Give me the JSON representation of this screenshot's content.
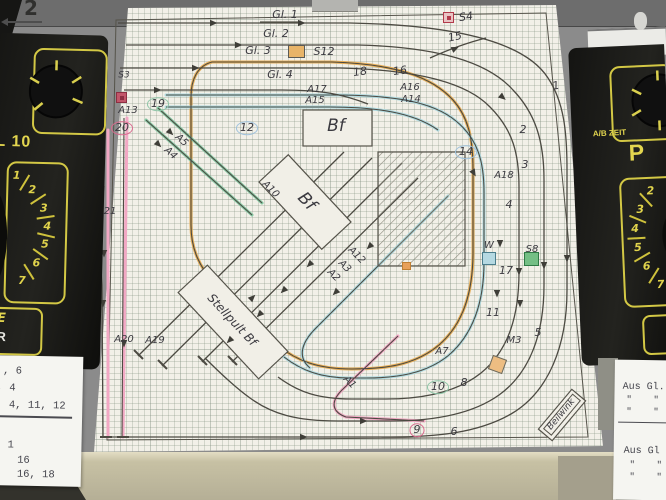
{
  "wall": {
    "number": "2"
  },
  "colors": {
    "pencil": "#4c4a42",
    "orange": "#e6ad56",
    "cyan": "#aed9df",
    "green": "#86c9a4",
    "pink": "#f2a8c4",
    "device_yellow": "#d9cf4e",
    "paper": "#f2f0e8"
  },
  "plan": {
    "labels": [
      {
        "t": "Gl. 1",
        "x": 285,
        "y": 15
      },
      {
        "t": "Gl. 2",
        "x": 276,
        "y": 34
      },
      {
        "t": "Gl. 3",
        "x": 258,
        "y": 51
      },
      {
        "t": "S12",
        "x": 324,
        "y": 52
      },
      {
        "t": "Gl. 4",
        "x": 280,
        "y": 75
      },
      {
        "t": "18",
        "x": 360,
        "y": 72,
        "r": -8
      },
      {
        "t": "16",
        "x": 400,
        "y": 71,
        "r": -8
      },
      {
        "t": "15",
        "x": 455,
        "y": 37,
        "r": -12
      },
      {
        "t": "S4",
        "x": 466,
        "y": 17,
        "r": -8
      },
      {
        "t": "1",
        "x": 556,
        "y": 86,
        "r": -10
      },
      {
        "t": "A17",
        "x": 317,
        "y": 90,
        "fs": 10
      },
      {
        "t": "A16",
        "x": 410,
        "y": 88,
        "fs": 10
      },
      {
        "t": "A15",
        "x": 315,
        "y": 101,
        "fs": 10
      },
      {
        "t": "A14",
        "x": 411,
        "y": 100,
        "fs": 10
      },
      {
        "t": "S3",
        "x": 124,
        "y": 76,
        "fs": 9
      },
      {
        "t": "A13",
        "x": 128,
        "y": 111,
        "fs": 10
      },
      {
        "t": "20",
        "x": 122,
        "y": 128,
        "circle": "#d96b8f"
      },
      {
        "t": "19",
        "x": 158,
        "y": 104,
        "circle": "#8fc6a8"
      },
      {
        "t": "21",
        "x": 110,
        "y": 212,
        "fs": 10
      },
      {
        "t": "12",
        "x": 247,
        "y": 128,
        "circle": "#9ec1dc"
      },
      {
        "t": "A5",
        "x": 181,
        "y": 141,
        "r": 42,
        "fs": 10
      },
      {
        "t": "A4",
        "x": 170,
        "y": 154,
        "r": 42,
        "fs": 10
      },
      {
        "t": "Bf",
        "x": 336,
        "y": 127,
        "fs": 17
      },
      {
        "t": "Bf",
        "x": 306,
        "y": 202,
        "fs": 17,
        "r": 47
      },
      {
        "t": "Stellpult Bf",
        "x": 232,
        "y": 320,
        "fs": 12,
        "r": 47
      },
      {
        "t": "A10",
        "x": 270,
        "y": 190,
        "r": 45,
        "fs": 10
      },
      {
        "t": "A12",
        "x": 356,
        "y": 256,
        "r": 45,
        "fs": 10
      },
      {
        "t": "A3",
        "x": 344,
        "y": 267,
        "r": 45,
        "fs": 10
      },
      {
        "t": "A2",
        "x": 333,
        "y": 276,
        "r": 45,
        "fs": 10
      },
      {
        "t": "A1",
        "x": 349,
        "y": 383,
        "r": 45,
        "fs": 10
      },
      {
        "t": "A20",
        "x": 124,
        "y": 340,
        "fs": 10
      },
      {
        "t": "A19",
        "x": 155,
        "y": 341,
        "fs": 10
      },
      {
        "t": "14",
        "x": 466,
        "y": 152,
        "circle": "#9ec1dc"
      },
      {
        "t": "2",
        "x": 523,
        "y": 130
      },
      {
        "t": "3",
        "x": 525,
        "y": 165
      },
      {
        "t": "A18",
        "x": 504,
        "y": 176,
        "fs": 10
      },
      {
        "t": "4",
        "x": 509,
        "y": 205
      },
      {
        "t": "W",
        "x": 489,
        "y": 246,
        "fs": 10
      },
      {
        "t": "17",
        "x": 506,
        "y": 271
      },
      {
        "t": "S8",
        "x": 532,
        "y": 250,
        "fs": 10
      },
      {
        "t": "11",
        "x": 493,
        "y": 313
      },
      {
        "t": "5",
        "x": 538,
        "y": 333
      },
      {
        "t": "M3",
        "x": 514,
        "y": 341,
        "fs": 10
      },
      {
        "t": "A7",
        "x": 442,
        "y": 352,
        "fs": 10
      },
      {
        "t": "10",
        "x": 438,
        "y": 387,
        "circle": "#8fc6a8"
      },
      {
        "t": "8",
        "x": 464,
        "y": 383
      },
      {
        "t": "9",
        "x": 417,
        "y": 430,
        "circle": "#d96b8f"
      },
      {
        "t": "6",
        "x": 454,
        "y": 432
      },
      {
        "t": "Beilwink",
        "x": 562,
        "y": 415,
        "r": -50,
        "box": true
      }
    ],
    "markers": [
      {
        "x": 443,
        "y": 12,
        "w": 11,
        "h": 11,
        "fill": "#e9c4c4",
        "stroke": "#b23a4a",
        "inner": true
      },
      {
        "x": 288,
        "y": 45,
        "w": 17,
        "h": 13,
        "fill": "#e8b469",
        "stroke": "#5a5a55"
      },
      {
        "x": 116,
        "y": 92,
        "w": 11,
        "h": 11,
        "fill": "#c2566a",
        "stroke": "#8c2f42",
        "inner": true
      },
      {
        "x": 482,
        "y": 252,
        "w": 14,
        "h": 13,
        "fill": "#b5d9e2",
        "stroke": "#4a7d8c"
      },
      {
        "x": 524,
        "y": 252,
        "w": 15,
        "h": 14,
        "fill": "#74bf85",
        "stroke": "#2f7a45"
      },
      {
        "x": 490,
        "y": 357,
        "w": 15,
        "h": 15,
        "fill": "#edbd82",
        "stroke": "#6a6a60",
        "rot": 20
      },
      {
        "x": 402,
        "y": 262,
        "w": 9,
        "h": 8,
        "fill": "#e8a05a",
        "stroke": "#c07f33"
      }
    ],
    "arrows": [
      [
        210,
        23,
        0
      ],
      [
        298,
        23,
        0
      ],
      [
        235,
        45,
        0
      ],
      [
        192,
        68,
        0
      ],
      [
        154,
        90,
        0
      ],
      [
        452,
        50,
        -25
      ],
      [
        500,
        95,
        40
      ],
      [
        472,
        170,
        60
      ],
      [
        567,
        255,
        90
      ],
      [
        544,
        262,
        90
      ],
      [
        519,
        268,
        90
      ],
      [
        500,
        240,
        90
      ],
      [
        497,
        290,
        90
      ],
      [
        520,
        300,
        90
      ],
      [
        312,
        262,
        135
      ],
      [
        286,
        288,
        135
      ],
      [
        338,
        290,
        135
      ],
      [
        262,
        312,
        135
      ],
      [
        232,
        338,
        135
      ],
      [
        372,
        244,
        135
      ],
      [
        250,
        300,
        -45
      ],
      [
        103,
        300,
        90
      ],
      [
        124,
        340,
        90
      ],
      [
        104,
        250,
        90
      ],
      [
        168,
        130,
        45
      ],
      [
        156,
        142,
        45
      ],
      [
        360,
        421,
        0
      ],
      [
        300,
        437,
        0
      ]
    ]
  },
  "left_device": {
    "model": "L 10",
    "dial_numbers": [
      "1",
      "2",
      "3",
      "4",
      "5",
      "6",
      "7"
    ],
    "box_line1": "E",
    "box_line2": "R"
  },
  "right_device": {
    "zeit_label": "A/B ZEIT",
    "p_label": "P",
    "dial_numbers": [
      "2",
      "3",
      "4",
      "5",
      "6",
      "7"
    ]
  },
  "papers": {
    "left": {
      "block1": [
        ", 6",
        ", 4",
        ", 4, 11, 12"
      ],
      "block2": [
        "1",
        "16",
        "16, 18"
      ]
    },
    "right": {
      "block1": [
        "Aus Gl.",
        "\"    \"",
        "\"    \""
      ],
      "block2": [
        "Aus Gl",
        "\"    \"",
        "\"    \""
      ]
    }
  }
}
